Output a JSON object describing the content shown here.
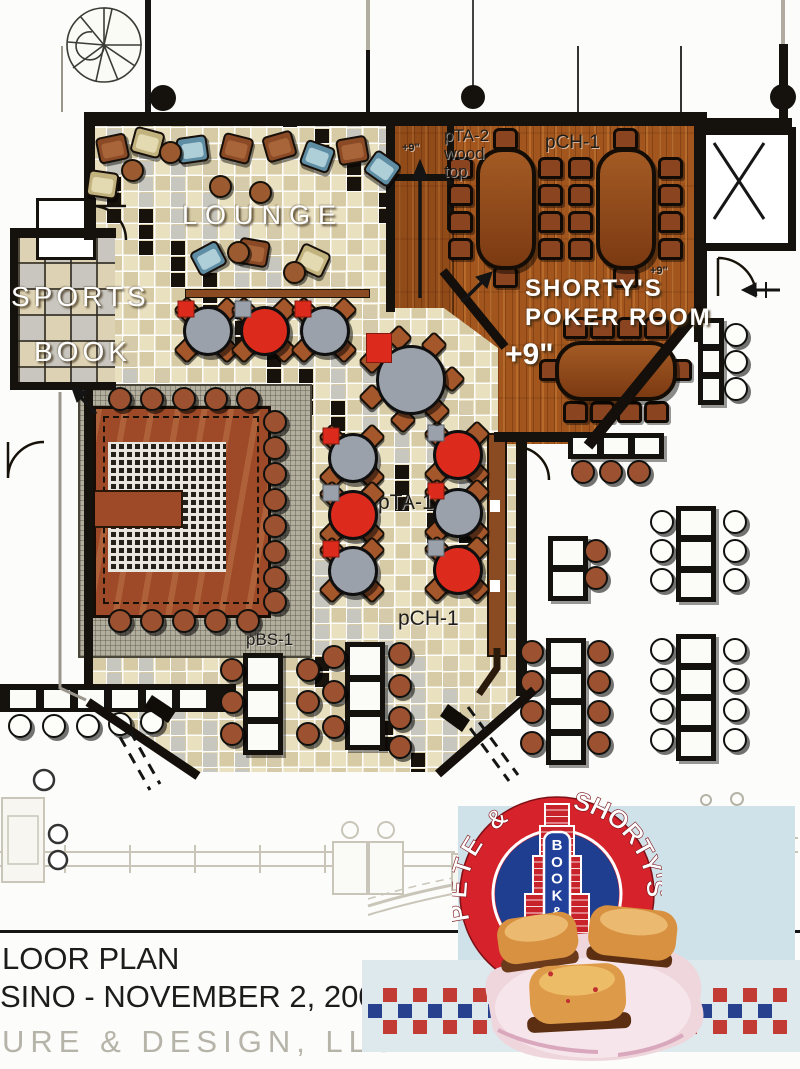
{
  "plan": {
    "rooms": {
      "lounge": "LOUNGE",
      "sports_line1": "SPORTS",
      "sports_line2": "BOOK",
      "poker_line1": "SHORTY'S",
      "poker_line2": "POKER ROOM"
    },
    "annotations": {
      "plus9_main": "+9\"",
      "plus9_ramp": "+9\"",
      "plus9_corner": "+9\"",
      "pta2_l1": "pTA-2",
      "pta2_l2": "wood",
      "pta2_l3": "top",
      "pch1_poker": "pCH-1",
      "pta1": "pTA-1",
      "pch1_dining": "pCH-1",
      "pbs1": "pBS-1"
    }
  },
  "title_block": {
    "line1": "LOOR PLAN",
    "line2": "SINO - NOVEMBER 2, 2004",
    "firm": "URE & DESIGN, LLC"
  },
  "logo": {
    "name_left": "PETE &",
    "name_right": "SHORTY'S",
    "sign_vertical": "BOOK & BAR"
  },
  "colors": {
    "logo_red": "#d6222a",
    "logo_blue": "#20409a",
    "wood_floor": "#a2561e",
    "bar_wood": "#9e4a28",
    "tile_beige": "#e9e0c0",
    "table_red": "#dc2a1c",
    "table_gray": "#9aa1ab",
    "band_red": "#c23b35",
    "band_blue": "#27418e"
  }
}
